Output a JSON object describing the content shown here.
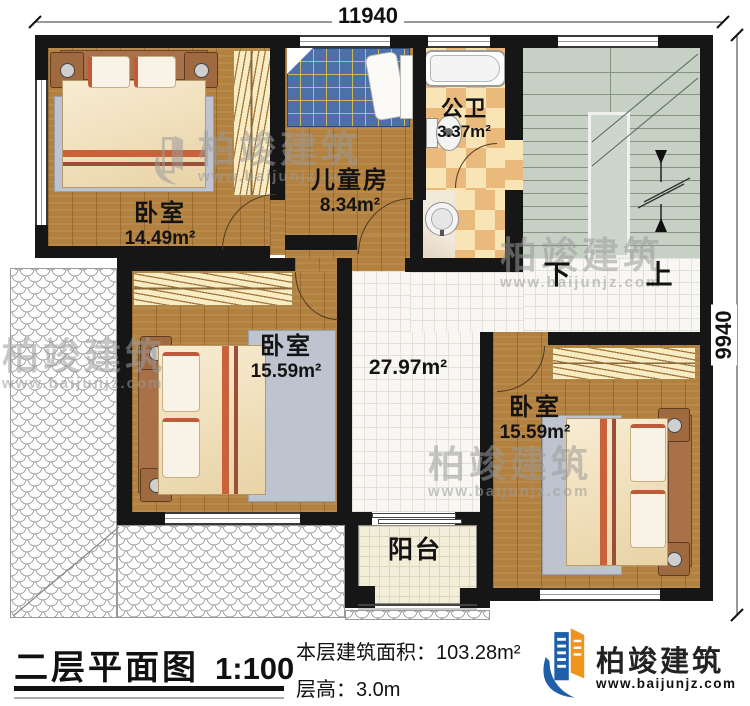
{
  "dimensions": {
    "width": "11940",
    "height": "9940"
  },
  "rooms": {
    "bedroom_nw": {
      "name": "卧室",
      "area": "14.49m²"
    },
    "kids_room": {
      "name": "儿童房",
      "area": "8.34m²"
    },
    "bathroom": {
      "name": "公卫",
      "area": "3.37m²"
    },
    "bedroom_w": {
      "name": "卧室",
      "area": "15.59m²"
    },
    "bedroom_se": {
      "name": "卧室",
      "area": "15.59m²"
    },
    "hall": {
      "area": "27.97m²"
    },
    "balcony": {
      "name": "阳台"
    }
  },
  "stairs": {
    "down_label": "下",
    "up_label": "上"
  },
  "footer": {
    "plan_title": "二层平面图",
    "plan_scale": "1:100",
    "floor_area_label": "本层建筑面积：",
    "floor_area_value": "103.28m²",
    "floor_height_label": "层高：",
    "floor_height_value": "3.0m"
  },
  "brand": {
    "name": "柏竣建筑",
    "website": "www.baijunjz.com"
  },
  "watermark": {
    "name": "柏竣建筑",
    "website": "www.baijunjz.com"
  },
  "colors": {
    "wall": "#161616",
    "wood_floor": "#b3813f",
    "stair_floor": "#c6d0c5",
    "hall_tile": "#f8f7f3",
    "bath_checker_dark": "#eab97c",
    "bath_checker_light": "#f8e4b4",
    "balcony_floor": "#f2eeda",
    "brand_blue": "#1f5fa8",
    "brand_orange": "#f0941d"
  }
}
